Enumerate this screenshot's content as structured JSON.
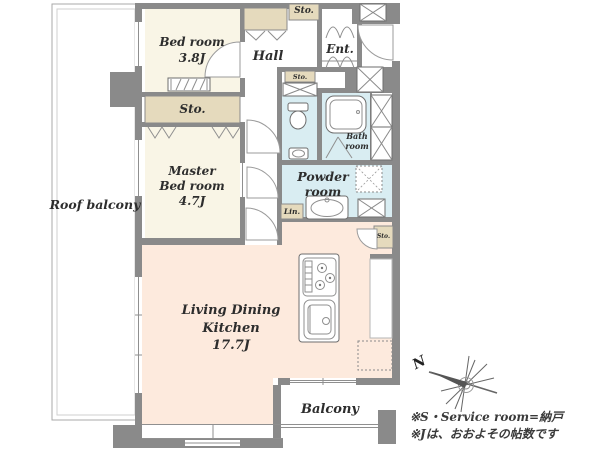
{
  "colors": {
    "wall": "#8a8a8a",
    "room_cream": "#f9f5e6",
    "storage_beige": "#e5dabd",
    "wet_area_blue": "#d9edf2",
    "living_peach": "#fdeadd",
    "text": "#2d2d2d"
  },
  "rooms": {
    "roof_balcony": {
      "label": "Roof balcony"
    },
    "bedroom": {
      "name": "Bed room",
      "size": "3.8J"
    },
    "hall": {
      "label": "Hall"
    },
    "entrance": {
      "label": "Ent."
    },
    "master_bedroom": {
      "line1": "Master",
      "line2": "Bed room",
      "size": "4.7J"
    },
    "bathroom": {
      "line1": "Bath",
      "line2": "room"
    },
    "powder_room": {
      "line1": "Powder",
      "line2": "room"
    },
    "living_dining_kitchen": {
      "line1": "Living Dining",
      "line2": "Kitchen",
      "size": "17.7J"
    },
    "balcony": {
      "label": "Balcony"
    },
    "storage_entrance": {
      "label": "Sto."
    },
    "storage_hall": {
      "label": "Sto."
    },
    "storage_master": {
      "label": "Sto."
    },
    "storage_kitchen": {
      "label": "Sto."
    },
    "linen": {
      "label": "Lin."
    }
  },
  "compass": {
    "north_label": "N"
  },
  "footnotes": {
    "line1": "※S・Service room=納戸",
    "line2": "※Jは、おおよその帖数です"
  }
}
